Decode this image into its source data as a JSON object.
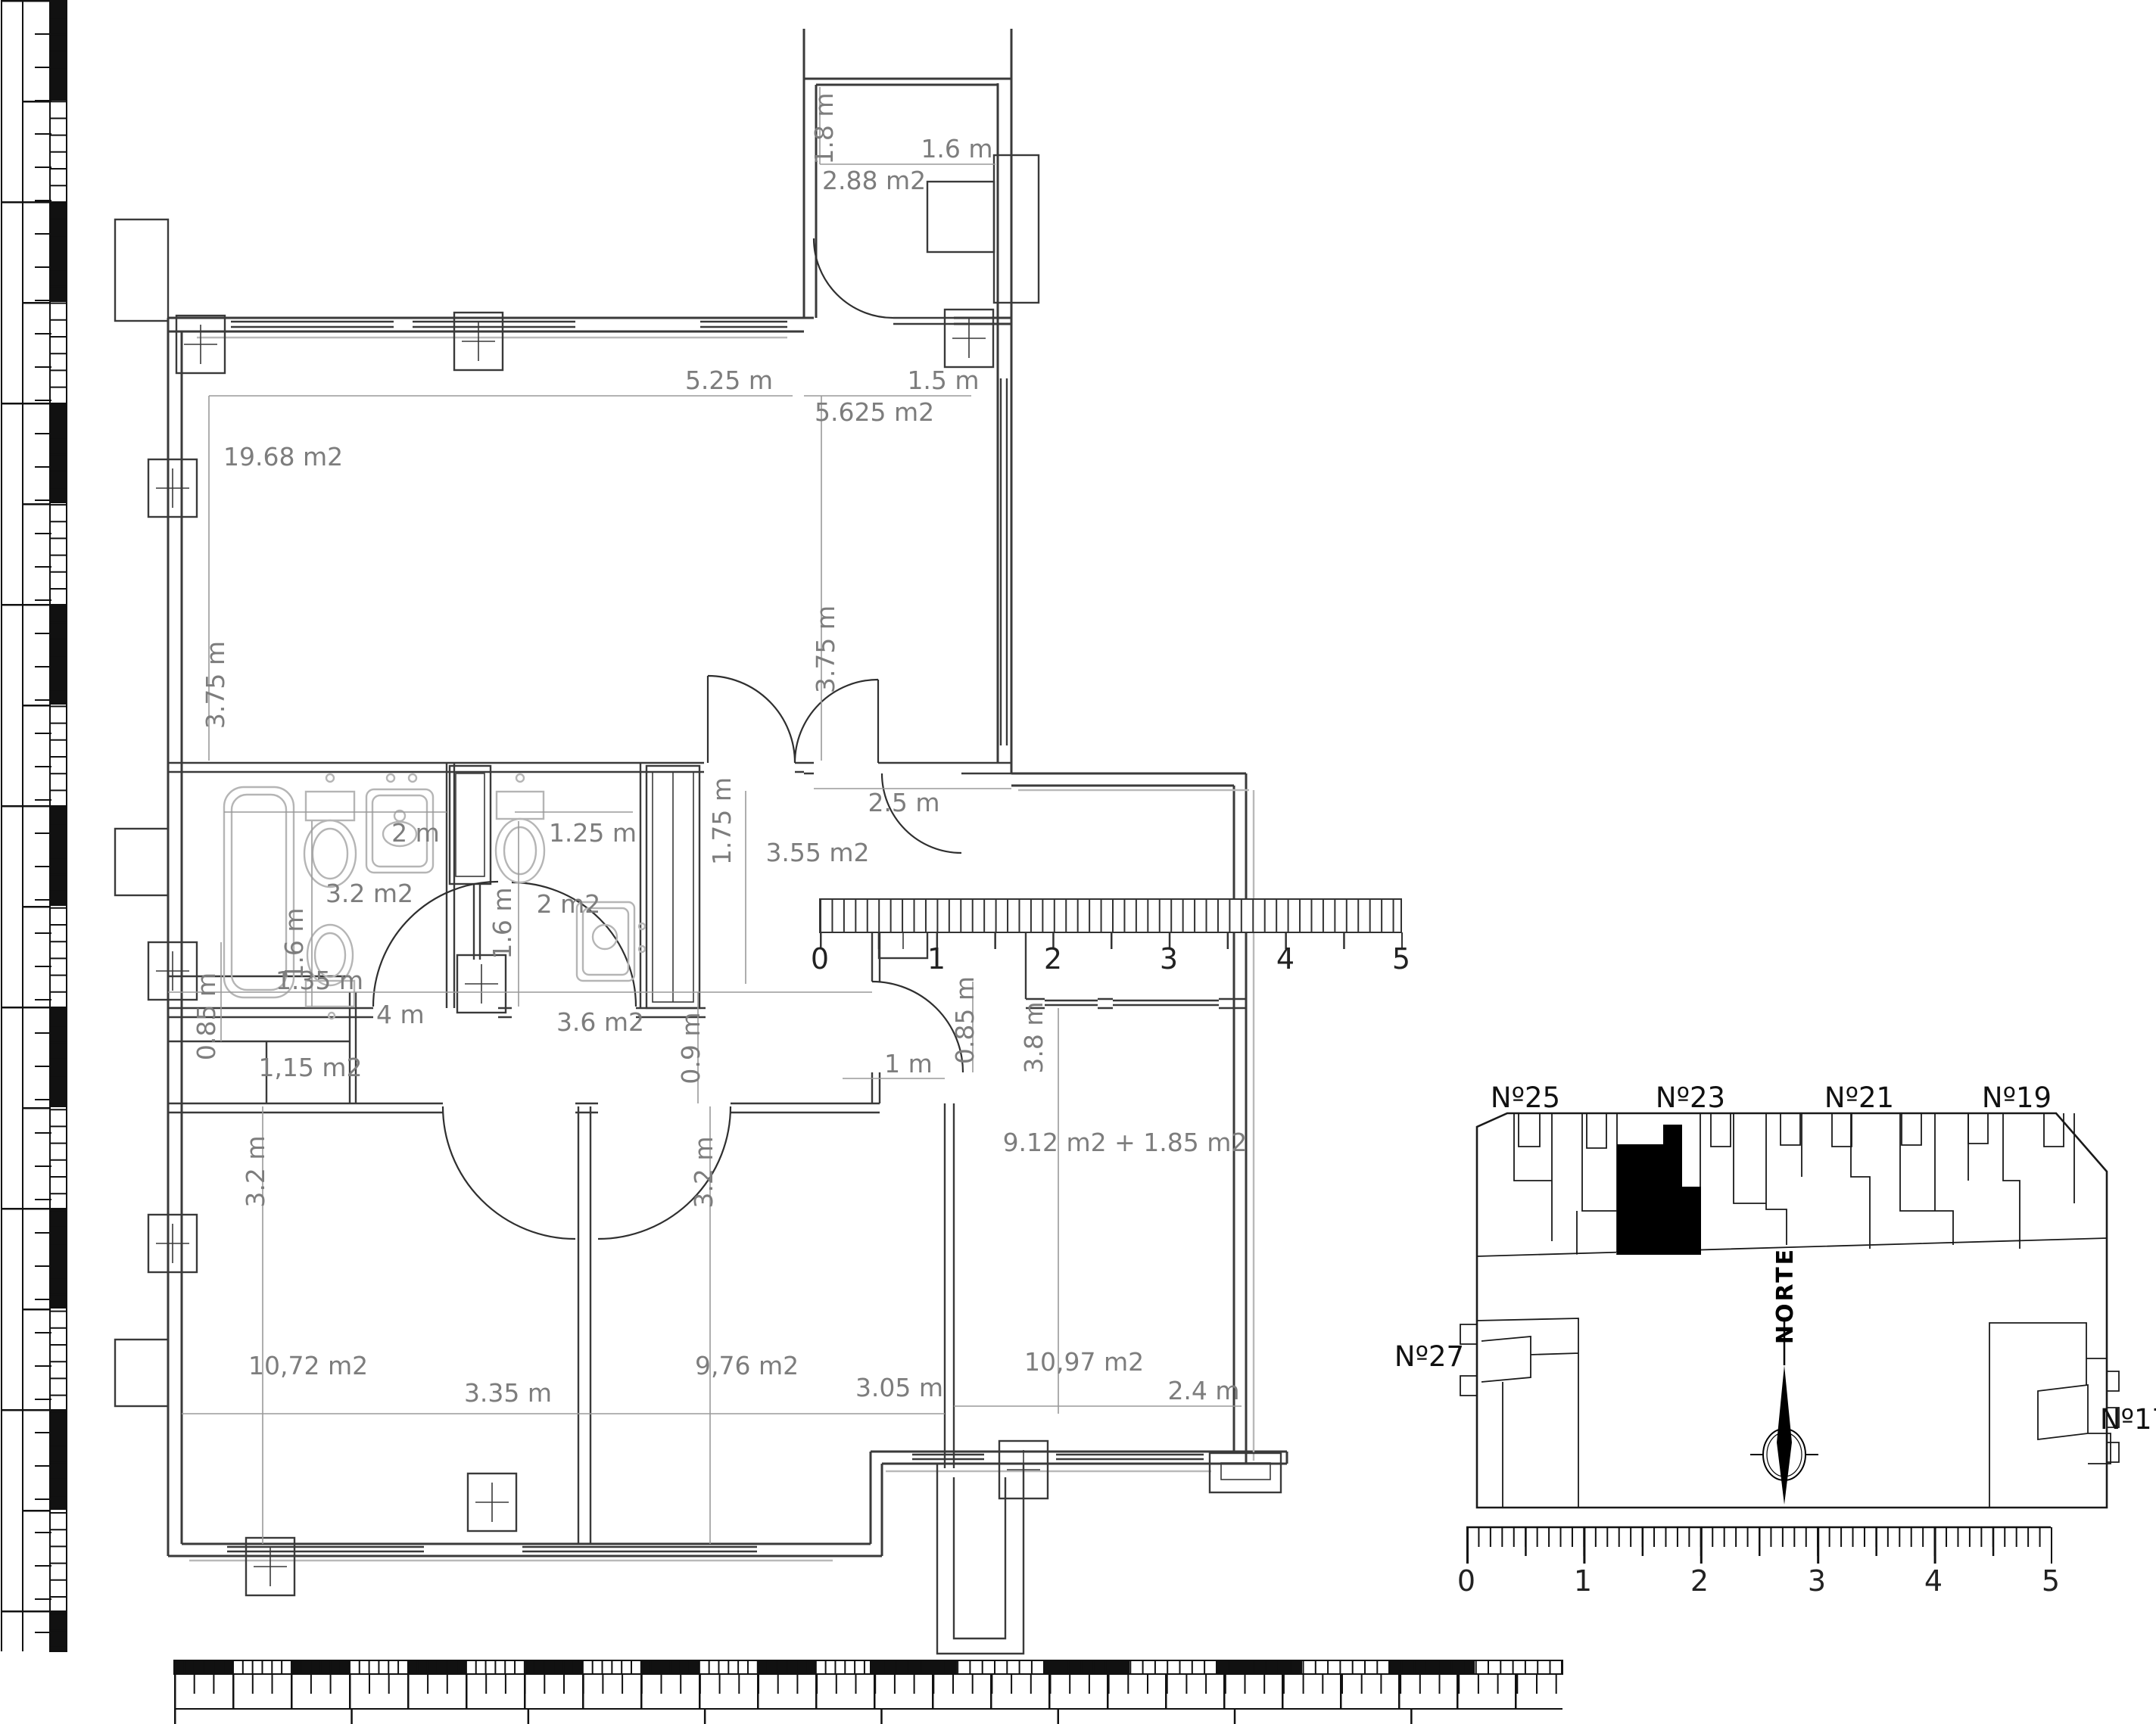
{
  "floor_plan": {
    "dimensions": {
      "terrace": {
        "height": "1.8 m",
        "width": "1.6 m",
        "area": "2.88 m2"
      },
      "living_room": {
        "area": "19.68 m2",
        "width": "5.25 m",
        "height": "3.75 m"
      },
      "bedroom_top_right": {
        "width": "1.5 m",
        "area": "5.625 m2",
        "height": "3.75 m"
      },
      "bathroom_main": {
        "width": "2 m",
        "area": "3.2 m2",
        "height": "1.6 m"
      },
      "bathroom_small": {
        "width": "1.25 m",
        "area": "2 m2",
        "height": "1.6 m"
      },
      "hall": {
        "height": "1.75 m",
        "area": "3.55 m2",
        "entry_width": "2.5 m"
      },
      "lobby": {
        "height": "0.85 m",
        "width": "1.35 m"
      },
      "closet": {
        "area": "1,15 m2"
      },
      "corridor": {
        "width": "4 m",
        "area": "3.6 m2",
        "height": "0.9 m"
      },
      "bedroom_left": {
        "area": "10,72 m2",
        "width": "3.35 m",
        "height": "3.2 m"
      },
      "bedroom_middle": {
        "area": "9,76 m2",
        "width": "3.05 m",
        "height": "3.2 m"
      },
      "living_dining": {
        "areas": "9.12 m2 + 1.85 m2",
        "total": "10,97 m2",
        "width": "2.4 m",
        "height": "3.8 m",
        "passage_width": "1 m",
        "passage_depth": "0.85 m"
      }
    },
    "ruler": {
      "unit_marks": [
        "0",
        "1",
        "2",
        "3",
        "4",
        "5"
      ]
    }
  },
  "site_plan": {
    "house_numbers": {
      "n25": "Nº25",
      "n23": "Nº23",
      "n21": "Nº21",
      "n19": "Nº19",
      "n17": "Nº17",
      "n27": "Nº27"
    },
    "north_label": "NORTE",
    "ruler": {
      "unit_marks": [
        "0",
        "1",
        "2",
        "3",
        "4",
        "5"
      ]
    }
  },
  "colors": {
    "wall": "#3a3a3a",
    "dimension_text": "#7d7d7d",
    "fixture": "#b5b5b5",
    "highlight": "#000000",
    "background": "#ffffff"
  }
}
